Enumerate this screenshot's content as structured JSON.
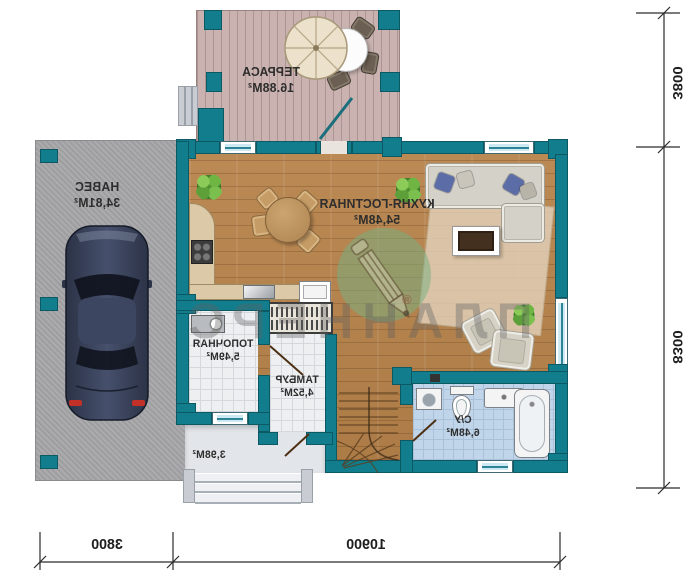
{
  "watermark": {
    "brand": "ПЛАННЕРС",
    "mark": "®"
  },
  "rooms": {
    "terrace": {
      "name": "ТЕРРАСА",
      "area": "16.88М²"
    },
    "carport": {
      "name": "НАВЕС",
      "area": "34,81М²"
    },
    "kitchen_living": {
      "name": "КУХНЯ-ГОСТИНАЯ",
      "area": "54,48М²"
    },
    "boiler": {
      "name": "ТОПОЧНАЯ",
      "area": "5,49М²"
    },
    "vestibule": {
      "name": "ТАМБУР",
      "area": "4,52М²"
    },
    "bathroom": {
      "name": "С/У",
      "area": "6,48М²"
    },
    "entry_porch": {
      "area": "3,98М²"
    }
  },
  "dimensions": {
    "right_top": "3800",
    "right_bottom": "8300",
    "bottom_left": "3800",
    "bottom_right": "10900"
  },
  "colors": {
    "wall_teal": "#127e8d",
    "wood_floor": "#b7834b",
    "terrace_deck": "#c9b2b0",
    "carport_concrete": "#a7a7a9",
    "bath_tile": "#c0d5e9",
    "watermark_green": "#76b082"
  }
}
